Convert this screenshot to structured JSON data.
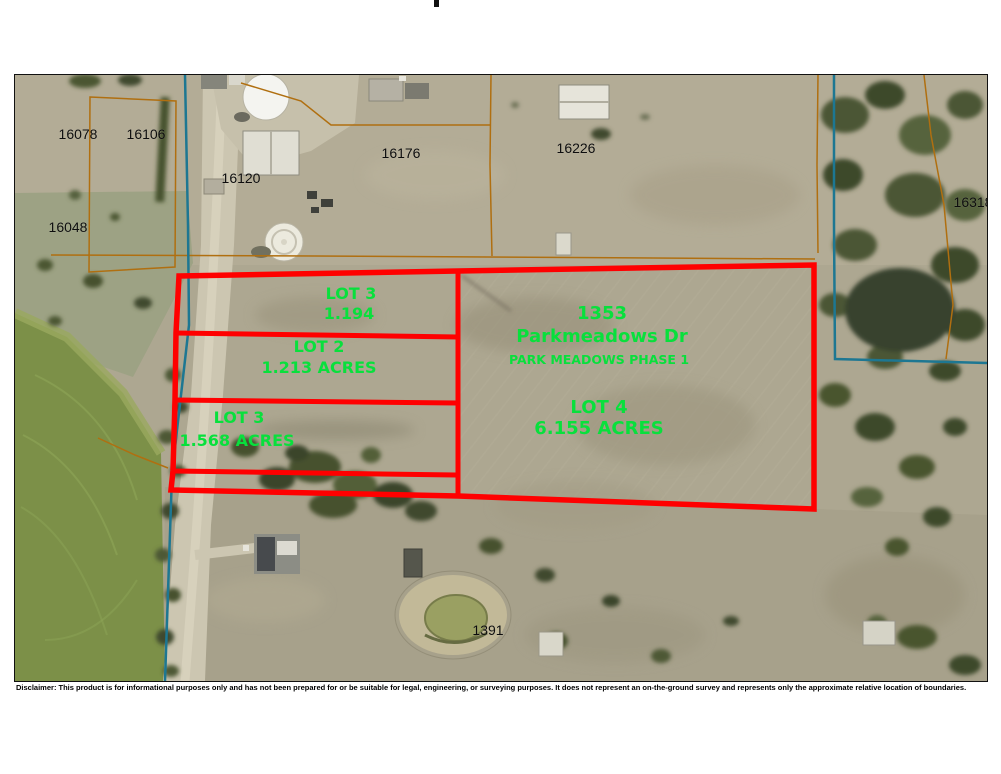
{
  "parcel_ids": {
    "p16078": "16078",
    "p16106": "16106",
    "p16120": "16120",
    "p16048": "16048",
    "p16176": "16176",
    "p16226": "16226",
    "p16318": "16318",
    "p1391": "1391"
  },
  "lots": {
    "lot3_top": {
      "name": "LOT 3",
      "acres": "1.194"
    },
    "lot2": {
      "name": "LOT 2",
      "acres": "1.213 ACRES"
    },
    "lot3_bottom": {
      "name": "LOT 3",
      "acres": "1.568 ACRES"
    },
    "lot4": {
      "name": "LOT 4",
      "acres": "6.155 ACRES"
    },
    "address": {
      "number": "1353",
      "street": "Parkmeadows Dr",
      "subdivision": "PARK MEADOWS PHASE 1"
    }
  },
  "disclaimer": "Disclaimer: This product is for informational purposes only and has not been prepared for or be suitable for legal, engineering, or surveying purposes. It does not represent an on-the-ground survey and represents only the approximate relative location of boundaries.",
  "colors": {
    "lot_boundary": "#ff0000",
    "lot_label_green": "#08e03c",
    "parcel_line_orange": "#b06f10",
    "city_boundary_teal": "#1d7792",
    "parcel_text": "#0d0d0d"
  }
}
